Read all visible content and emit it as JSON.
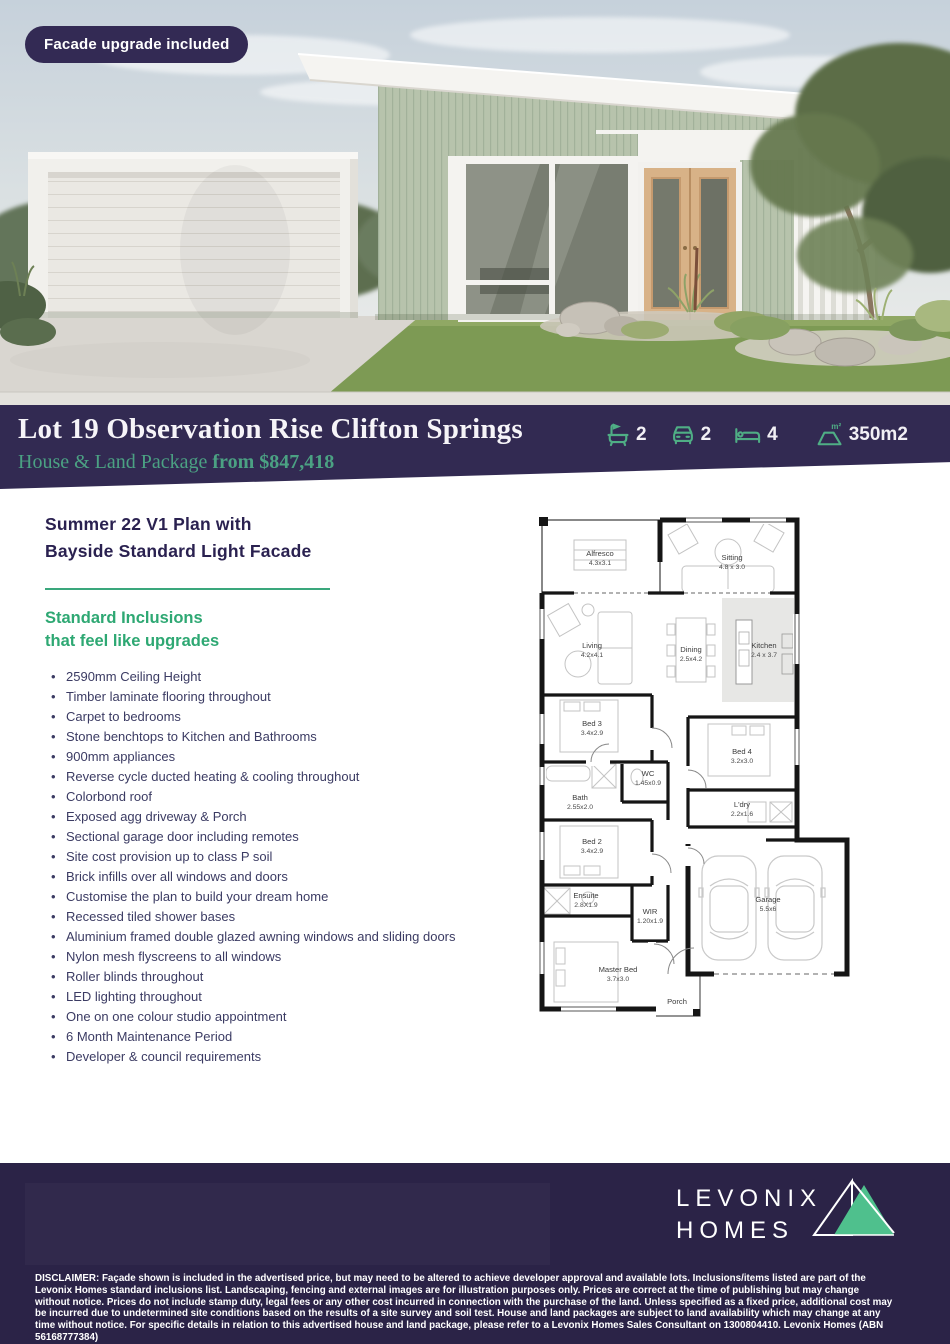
{
  "colors": {
    "purple_dark": "#322a52",
    "purple_footer": "#2b2347",
    "green_accent": "#3aa77c",
    "green_text": "#2ea873",
    "green_banner_text": "#4ba183",
    "green_logo": "#4fc08d",
    "navy_heading": "#2a2150",
    "body_text": "#3b3b63"
  },
  "hero": {
    "badge_label": "Facade upgrade included"
  },
  "banner": {
    "title": "Lot 19 Observation Rise Clifton Springs",
    "subtitle_prefix": "House & Land Package ",
    "subtitle_price": "from $847,418",
    "specs": [
      {
        "name": "bathrooms",
        "icon": "bath-icon",
        "value": "2"
      },
      {
        "name": "car-spaces",
        "icon": "car-icon",
        "value": "2"
      },
      {
        "name": "bedrooms",
        "icon": "bed-icon",
        "value": "4"
      },
      {
        "name": "land-size",
        "icon": "area-icon",
        "value": "350m2"
      }
    ]
  },
  "plan_section": {
    "title_line1": "Summer 22 V1 Plan with",
    "title_line2": "Bayside Standard Light  Facade",
    "inclusions_heading_line1": "Standard Inclusions",
    "inclusions_heading_line2": "that feel like upgrades",
    "inclusions": [
      "2590mm Ceiling Height",
      "Timber laminate flooring throughout",
      "Carpet to bedrooms",
      "Stone benchtops to Kitchen and Bathrooms",
      "900mm appliances",
      "Reverse cycle ducted heating & cooling throughout",
      "Colorbond roof",
      "Exposed agg driveway & Porch",
      "Sectional garage door including remotes",
      "Site cost provision up to class P soil",
      "Brick infills over all windows and doors",
      "Customise the plan to build your dream home",
      "Recessed tiled shower bases",
      "Aluminium framed double glazed awning windows and sliding doors",
      "Nylon mesh flyscreens to all windows",
      "Roller blinds throughout",
      "LED lighting throughout",
      "One on one colour studio appointment",
      "6 Month Maintenance Period",
      "Developer & council requirements"
    ]
  },
  "floor_plan": {
    "rooms": [
      {
        "name": "Alfresco",
        "dims": "4.3x3.1"
      },
      {
        "name": "Sitting",
        "dims": "4.8 x 3.0"
      },
      {
        "name": "Living",
        "dims": "4.2x4.1"
      },
      {
        "name": "Dining",
        "dims": "2.5x4.2"
      },
      {
        "name": "Kitchen",
        "dims": "2.4 x 3.7"
      },
      {
        "name": "Bed 3",
        "dims": "3.4x2.9"
      },
      {
        "name": "WC",
        "dims": "1.45x0.9"
      },
      {
        "name": "Bath",
        "dims": "2.55x2.0"
      },
      {
        "name": "Bed 4",
        "dims": "3.2x3.0"
      },
      {
        "name": "L'dry",
        "dims": "2.2x1.6"
      },
      {
        "name": "Bed 2",
        "dims": "3.4x2.9"
      },
      {
        "name": "Ensuite",
        "dims": "2.8X1.9"
      },
      {
        "name": "WIR",
        "dims": "1.20x1.9"
      },
      {
        "name": "Master Bed",
        "dims": "3.7x3.0"
      },
      {
        "name": "Garage",
        "dims": "5.5x6"
      },
      {
        "name": "Porch",
        "dims": ""
      }
    ]
  },
  "footer": {
    "brand_line1": "LEVONIX",
    "brand_line2": "HOMES",
    "disclaimer": "DISCLAIMER: Façade shown is included in the advertised price, but may need to be altered to achieve developer approval and available lots. Inclusions/items listed are part of the Levonix Homes standard inclusions list. Landscaping, fencing and external images are for illustration purposes only. Prices are correct at the time of publishing but may change without notice. Prices do not include stamp duty, legal fees or any other cost incurred in connection with the purchase of the land. Unless specified as a fixed price, additional cost may be incurred due to undetermined site conditions based on the results of a site survey and soil test. House and land packages are subject to land availability which may change at any time without notice. For specific details in relation to this advertised house and land package, please refer to a Levonix Homes Sales Consultant on 1300804410. Levonix Homes (ABN 56168777384)"
  }
}
